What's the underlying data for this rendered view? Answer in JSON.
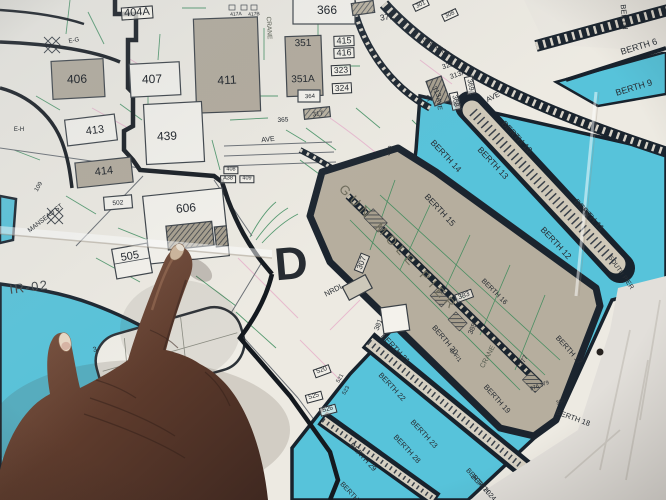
{
  "scene": {
    "description": "Photograph of a paper harbor map; a hand with index finger points at building 606",
    "district_letter": "D"
  },
  "colors": {
    "paper": "#edeae2",
    "water": "#57c3da",
    "pier_tan": "#b6ae9e",
    "pier_core": "#cfc8b8",
    "dark_line": "#18222c",
    "utility_green": "#2f8653",
    "utility_pink": "#e5aac8",
    "text": "#272c32",
    "skin_light": "#8a5d46",
    "skin_dark": "#3f2820",
    "nail": "#ccb49a",
    "offmap_paper": "#e2dfda"
  },
  "map": {
    "labels": [
      {
        "n": "building-404a",
        "t": "404A",
        "x": 137,
        "y": 13,
        "r": -4,
        "s": 11,
        "b": 1
      },
      {
        "n": "building-406",
        "t": "406",
        "x": 77,
        "y": 79,
        "r": -2,
        "s": 12
      },
      {
        "n": "building-407",
        "t": "407",
        "x": 152,
        "y": 79,
        "r": -2,
        "s": 12
      },
      {
        "n": "building-411",
        "t": "411",
        "x": 227,
        "y": 80,
        "r": -3,
        "s": 12
      },
      {
        "n": "building-413",
        "t": "413",
        "x": 95,
        "y": 131,
        "r": -7,
        "s": 11
      },
      {
        "n": "building-439",
        "t": "439",
        "x": 167,
        "y": 136,
        "r": -3,
        "s": 12
      },
      {
        "n": "building-414",
        "t": "414",
        "x": 104,
        "y": 172,
        "r": -6,
        "s": 11
      },
      {
        "n": "building-366",
        "t": "366",
        "x": 327,
        "y": 10,
        "r": 0,
        "s": 12
      },
      {
        "n": "building-372",
        "t": "372",
        "x": 387,
        "y": 17,
        "r": -8,
        "s": 8.5
      },
      {
        "n": "building-417a",
        "t": "417A",
        "x": 236,
        "y": 15,
        "r": -4,
        "s": 5
      },
      {
        "n": "building-417b",
        "t": "417B",
        "x": 254,
        "y": 15,
        "r": -4,
        "s": 5
      },
      {
        "n": "building-351",
        "t": "351",
        "x": 303,
        "y": 44,
        "r": -2,
        "s": 10
      },
      {
        "n": "building-351a",
        "t": "351A",
        "x": 303,
        "y": 80,
        "r": -2,
        "s": 10
      },
      {
        "n": "building-415",
        "t": "415",
        "x": 344,
        "y": 41,
        "r": -2,
        "s": 9,
        "b": 1
      },
      {
        "n": "building-416",
        "t": "416",
        "x": 344,
        "y": 53,
        "r": -2,
        "s": 9,
        "b": 1
      },
      {
        "n": "building-323",
        "t": "323",
        "x": 341,
        "y": 70,
        "r": -3,
        "s": 8.5,
        "b": 1
      },
      {
        "n": "building-324",
        "t": "324",
        "x": 342,
        "y": 88,
        "r": -3,
        "s": 8.5,
        "b": 1
      },
      {
        "n": "building-364",
        "t": "364",
        "x": 310,
        "y": 97,
        "r": -3,
        "s": 6
      },
      {
        "n": "building-365",
        "t": "365",
        "x": 283,
        "y": 121,
        "r": -3,
        "s": 6.5
      },
      {
        "n": "building-317",
        "t": "317",
        "x": 318,
        "y": 115,
        "r": -8,
        "s": 6.5
      },
      {
        "n": "building-322",
        "t": "322",
        "x": 448,
        "y": 66,
        "r": -18,
        "s": 7
      },
      {
        "n": "building-313a",
        "t": "313A",
        "x": 458,
        "y": 75,
        "r": -18,
        "s": 7
      },
      {
        "n": "building-313",
        "t": "313",
        "x": 436,
        "y": 92,
        "r": 62,
        "s": 7
      },
      {
        "n": "street-st",
        "t": "ST",
        "x": 427,
        "y": 99,
        "r": 62,
        "s": 6
      },
      {
        "n": "building-369",
        "t": "369",
        "x": 470,
        "y": 85,
        "r": 78,
        "s": 7,
        "b": 1
      },
      {
        "n": "building-368",
        "t": "368",
        "x": 455,
        "y": 101,
        "r": 78,
        "s": 7,
        "b": 1
      },
      {
        "n": "street-ave-east",
        "t": "AVE",
        "x": 493,
        "y": 97,
        "r": -28,
        "s": 7.5
      },
      {
        "n": "building-301",
        "t": "301",
        "x": 421,
        "y": 5,
        "r": -25,
        "s": 6,
        "b": 1
      },
      {
        "n": "building-308",
        "t": "308",
        "x": 450,
        "y": 15,
        "r": -25,
        "s": 6,
        "b": 1
      },
      {
        "n": "street-308a-308",
        "t": "308A/308",
        "x": 436,
        "y": 47,
        "r": 33,
        "s": 7
      },
      {
        "n": "building-390",
        "t": "390",
        "x": 390,
        "y": 151,
        "r": -70,
        "s": 6
      },
      {
        "n": "building-408",
        "t": "408",
        "x": 231,
        "y": 170,
        "r": 0,
        "s": 5.5,
        "b": 1
      },
      {
        "n": "building-a38",
        "t": "A38",
        "x": 228,
        "y": 179,
        "r": 0,
        "s": 5.5,
        "b": 1
      },
      {
        "n": "building-409",
        "t": "409",
        "x": 247,
        "y": 179,
        "r": 0,
        "s": 5.5,
        "b": 1
      },
      {
        "n": "street-ave-center",
        "t": "AVE",
        "x": 268,
        "y": 140,
        "r": -6,
        "s": 7
      },
      {
        "n": "street-ave-north",
        "t": "AVE",
        "x": 438,
        "y": 104,
        "r": 82,
        "s": 6.5
      },
      {
        "n": "label-e-g",
        "t": "E-G",
        "x": 74,
        "y": 41,
        "r": -10,
        "s": 6
      },
      {
        "n": "label-e-h",
        "t": "E-H",
        "x": 19,
        "y": 130,
        "r": 0,
        "s": 6
      },
      {
        "n": "building-109",
        "t": "109",
        "x": 39,
        "y": 187,
        "r": -60,
        "s": 6
      },
      {
        "n": "street-manseau",
        "t": "MANSEAU ST",
        "x": 46,
        "y": 219,
        "r": -38,
        "s": 6.5
      },
      {
        "n": "building-502",
        "t": "502",
        "x": 118,
        "y": 204,
        "r": -5,
        "s": 6.5
      },
      {
        "n": "building-606",
        "t": "606",
        "x": 186,
        "y": 208,
        "r": -5,
        "s": 12
      },
      {
        "n": "building-505",
        "t": "505",
        "x": 130,
        "y": 257,
        "r": -10,
        "s": 11
      },
      {
        "n": "site-ir-02",
        "t": "IR-02",
        "x": 29,
        "y": 287,
        "r": -7,
        "s": 13,
        "sp": 1.5,
        "c": "#4a4f52"
      },
      {
        "n": "district-letter-d",
        "t": "D",
        "x": 291,
        "y": 263,
        "r": -5,
        "s": 46,
        "w": 900
      },
      {
        "n": "street-nrdl",
        "t": "NRDL",
        "x": 334,
        "y": 290,
        "r": -28,
        "s": 7.5
      },
      {
        "n": "building-307",
        "t": "307",
        "x": 362,
        "y": 263,
        "r": -68,
        "s": 8,
        "b": 1
      },
      {
        "n": "gun-mole-pier",
        "t": "GUN MOLE PIER",
        "x": 399,
        "y": 248,
        "r": 47,
        "s": 13,
        "sp": 5,
        "c": "#6e6c5c"
      },
      {
        "n": "building-381",
        "t": "381",
        "x": 379,
        "y": 325,
        "r": -68,
        "s": 7
      },
      {
        "n": "building-383",
        "t": "383",
        "x": 464,
        "y": 296,
        "r": -20,
        "s": 7,
        "b": 1
      },
      {
        "n": "building-385",
        "t": "385",
        "x": 473,
        "y": 329,
        "r": -65,
        "s": 7
      },
      {
        "n": "label-crane-pier",
        "t": "CRANE",
        "x": 488,
        "y": 357,
        "r": -62,
        "s": 7,
        "c": "#555b50"
      },
      {
        "n": "building-377",
        "t": "377",
        "x": 524,
        "y": 361,
        "r": -62,
        "s": 7
      },
      {
        "n": "building-376-379",
        "t": "376 379",
        "x": 540,
        "y": 387,
        "r": -20,
        "s": 5.5
      },
      {
        "n": "building-380",
        "t": "380",
        "x": 561,
        "y": 403,
        "r": -20,
        "s": 5.5
      },
      {
        "n": "building-520",
        "t": "520",
        "x": 322,
        "y": 371,
        "r": -20,
        "s": 6.5,
        "b": 1
      },
      {
        "n": "building-521",
        "t": "521",
        "x": 341,
        "y": 379,
        "r": -60,
        "s": 5.5
      },
      {
        "n": "building-523",
        "t": "523",
        "x": 347,
        "y": 391,
        "r": -60,
        "s": 5.5
      },
      {
        "n": "building-525",
        "t": "525",
        "x": 314,
        "y": 397,
        "r": -15,
        "s": 6.5,
        "b": 1
      },
      {
        "n": "building-526",
        "t": "526",
        "x": 328,
        "y": 410,
        "r": -15,
        "s": 6.5,
        "b": 1
      },
      {
        "n": "label-crane-yard",
        "t": "CRANE",
        "x": 268,
        "y": 28,
        "r": 87,
        "s": 6.5,
        "c": "#555b50"
      },
      {
        "n": "label-berth-top",
        "t": "BERTH",
        "x": 624,
        "y": 17,
        "r": 85,
        "s": 7.5
      },
      {
        "n": "berth-6",
        "t": "BERTH 6",
        "x": 639,
        "y": 47,
        "r": -17,
        "s": 9
      },
      {
        "n": "berth-9",
        "t": "BERTH 9",
        "x": 634,
        "y": 88,
        "r": -17,
        "s": 9
      },
      {
        "n": "berth-10",
        "t": "BERTH 10",
        "x": 517,
        "y": 137,
        "r": 47,
        "s": 8.5
      },
      {
        "n": "berth-11",
        "t": "BERTH 11",
        "x": 589,
        "y": 215,
        "r": 47,
        "s": 8.5
      },
      {
        "n": "berth-12",
        "t": "BERTH 12",
        "x": 556,
        "y": 243,
        "r": 47,
        "s": 8.5
      },
      {
        "n": "berth-13",
        "t": "BERTH 13",
        "x": 493,
        "y": 163,
        "r": 47,
        "s": 8.5
      },
      {
        "n": "berth-14",
        "t": "BERTH 14",
        "x": 446,
        "y": 156,
        "r": 47,
        "s": 8.5
      },
      {
        "n": "berth-15",
        "t": "BERTH 15",
        "x": 440,
        "y": 210,
        "r": 47,
        "s": 8.5
      },
      {
        "n": "south-pier",
        "t": "SOUTH PIER",
        "x": 620,
        "y": 273,
        "r": 55,
        "s": 6.5
      },
      {
        "n": "berth-16",
        "t": "BERTH 16",
        "x": 494,
        "y": 292,
        "r": 45,
        "s": 7
      },
      {
        "n": "berth-17",
        "t": "BERTH 17",
        "x": 569,
        "y": 350,
        "r": 48,
        "s": 7.5
      },
      {
        "n": "berth-18",
        "t": "BERTH 18",
        "x": 573,
        "y": 418,
        "r": 20,
        "s": 7.5
      },
      {
        "n": "berth-19",
        "t": "BERTH 19",
        "x": 497,
        "y": 399,
        "r": 48,
        "s": 7.5
      },
      {
        "n": "berth-20",
        "t": "BERTH 20",
        "x": 445,
        "y": 340,
        "r": 50,
        "s": 7.5
      },
      {
        "n": "label-b-f1",
        "t": "B-F/1",
        "x": 455,
        "y": 356,
        "r": 50,
        "s": 6
      },
      {
        "n": "berth-20-south",
        "t": "BERTH 20",
        "x": 478,
        "y": 482,
        "r": 48,
        "s": 7
      },
      {
        "n": "berth-21",
        "t": "BERTH 21",
        "x": 395,
        "y": 349,
        "r": 47,
        "s": 8
      },
      {
        "n": "berth-22",
        "t": "BERTH 22",
        "x": 392,
        "y": 387,
        "r": 47,
        "s": 7.5
      },
      {
        "n": "berth-23",
        "t": "BERTH 23",
        "x": 424,
        "y": 434,
        "r": 47,
        "s": 7.5
      },
      {
        "n": "berth-24",
        "t": "BERTH 24",
        "x": 483,
        "y": 488,
        "r": 47,
        "s": 7
      },
      {
        "n": "berth-28",
        "t": "BERTH 28",
        "x": 407,
        "y": 449,
        "r": 47,
        "s": 7.5
      },
      {
        "n": "berth-29",
        "t": "BERTH 29",
        "x": 363,
        "y": 457,
        "r": 47,
        "s": 7.5
      },
      {
        "n": "berth-partial",
        "t": "BERTH",
        "x": 349,
        "y": 492,
        "r": 47,
        "s": 7
      },
      {
        "n": "dock-number-3",
        "t": "3",
        "x": 95,
        "y": 350,
        "r": -15,
        "s": 7
      }
    ]
  }
}
